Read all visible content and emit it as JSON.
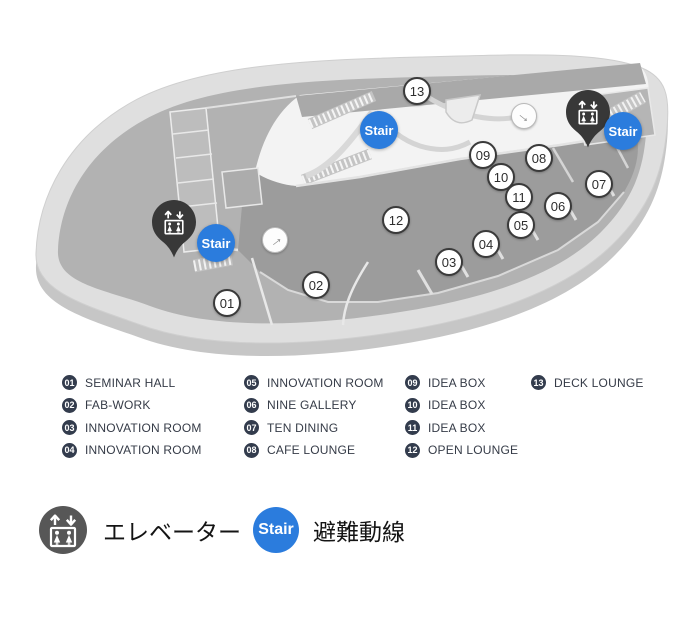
{
  "map": {
    "markers": [
      "01",
      "02",
      "03",
      "04",
      "05",
      "06",
      "07",
      "08",
      "09",
      "10",
      "11",
      "12",
      "13"
    ],
    "stair_label": "Stair",
    "arrow_glyph": "→"
  },
  "legend": {
    "columns": [
      {
        "items": [
          {
            "num": "01",
            "label": "SEMINAR HALL"
          },
          {
            "num": "02",
            "label": "FAB-WORK"
          },
          {
            "num": "03",
            "label": "INNOVATION ROOM"
          },
          {
            "num": "04",
            "label": "INNOVATION ROOM"
          }
        ]
      },
      {
        "items": [
          {
            "num": "05",
            "label": "INNOVATION ROOM"
          },
          {
            "num": "06",
            "label": "NINE GALLERY"
          },
          {
            "num": "07",
            "label": "TEN DINING"
          },
          {
            "num": "08",
            "label": "CAFE LOUNGE"
          }
        ]
      },
      {
        "items": [
          {
            "num": "09",
            "label": "IDEA BOX"
          },
          {
            "num": "10",
            "label": "IDEA BOX"
          },
          {
            "num": "11",
            "label": "IDEA BOX"
          },
          {
            "num": "12",
            "label": "OPEN LOUNGE"
          }
        ]
      },
      {
        "items": [
          {
            "num": "13",
            "label": "DECK LOUNGE"
          }
        ]
      }
    ]
  },
  "footer": {
    "elevator_label": "エレベーター",
    "stair_badge": "Stair",
    "evacuation_label": "避難動線"
  },
  "colors": {
    "accent_blue": "#2b7cdd",
    "badge_navy": "#333c4d",
    "pin_charcoal": "#383838",
    "elevator_gray": "#575757",
    "marker_border": "#3a3a3a"
  }
}
